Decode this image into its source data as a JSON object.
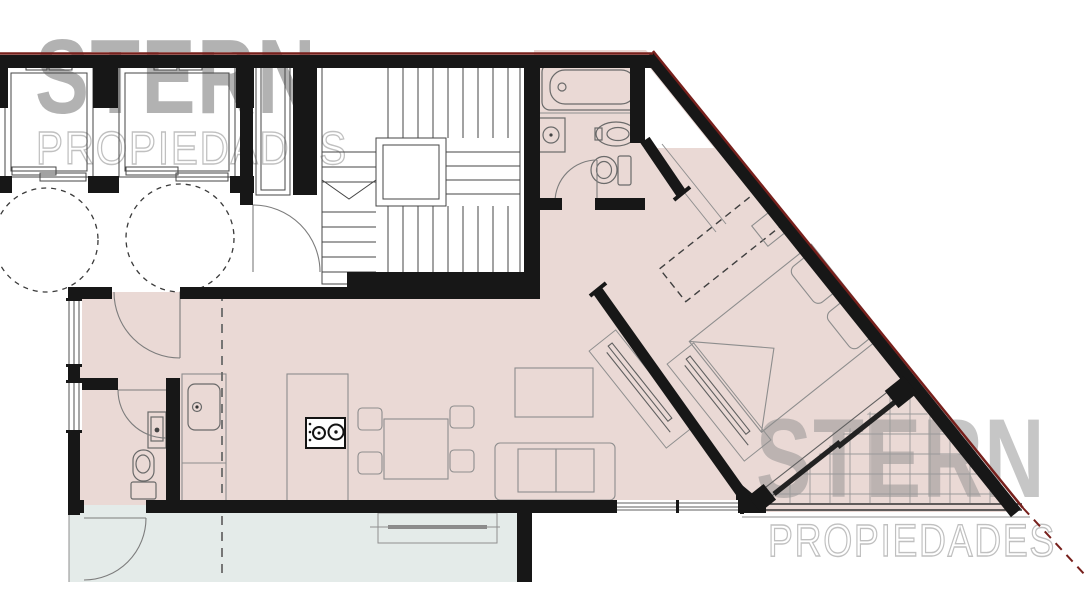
{
  "title": "Apartment floor plan",
  "watermark": {
    "brand": "STERN",
    "subtitle": "PROPIEDADES"
  },
  "colors": {
    "background": "#ffffff",
    "wall": "#171717",
    "interior_floor": "#ead9d5",
    "balcony_floor": "#e4ebe9",
    "boundary_line": "#77201c",
    "watermark_solid": "#8f8f8f",
    "watermark_outline": "#bdbdbd",
    "linework": "#5f5f5f",
    "furniture_line": "#8d8d8d",
    "stair_line": "#454545"
  },
  "plan": {
    "common_areas": {
      "elevator_shafts": 2,
      "stairwell": 1,
      "lobby_turning_circles": 2
    },
    "rooms": [
      "entry-hall",
      "living-dining",
      "kitchen",
      "powder-room",
      "bathroom",
      "bedroom",
      "balcony",
      "terrace-deck"
    ],
    "fixtures": [
      "bathtub",
      "vanity-sink",
      "bidet",
      "toilet",
      "powder-toilet",
      "powder-basin",
      "kitchen-sink",
      "cooktop"
    ],
    "furniture": [
      "bed",
      "pillows",
      "nightstand",
      "dashed-wardrobe-outline",
      "sliding-closet-panels",
      "sofa",
      "coffee-table",
      "dining-table",
      "dining-chairs",
      "balcony-bench"
    ]
  }
}
